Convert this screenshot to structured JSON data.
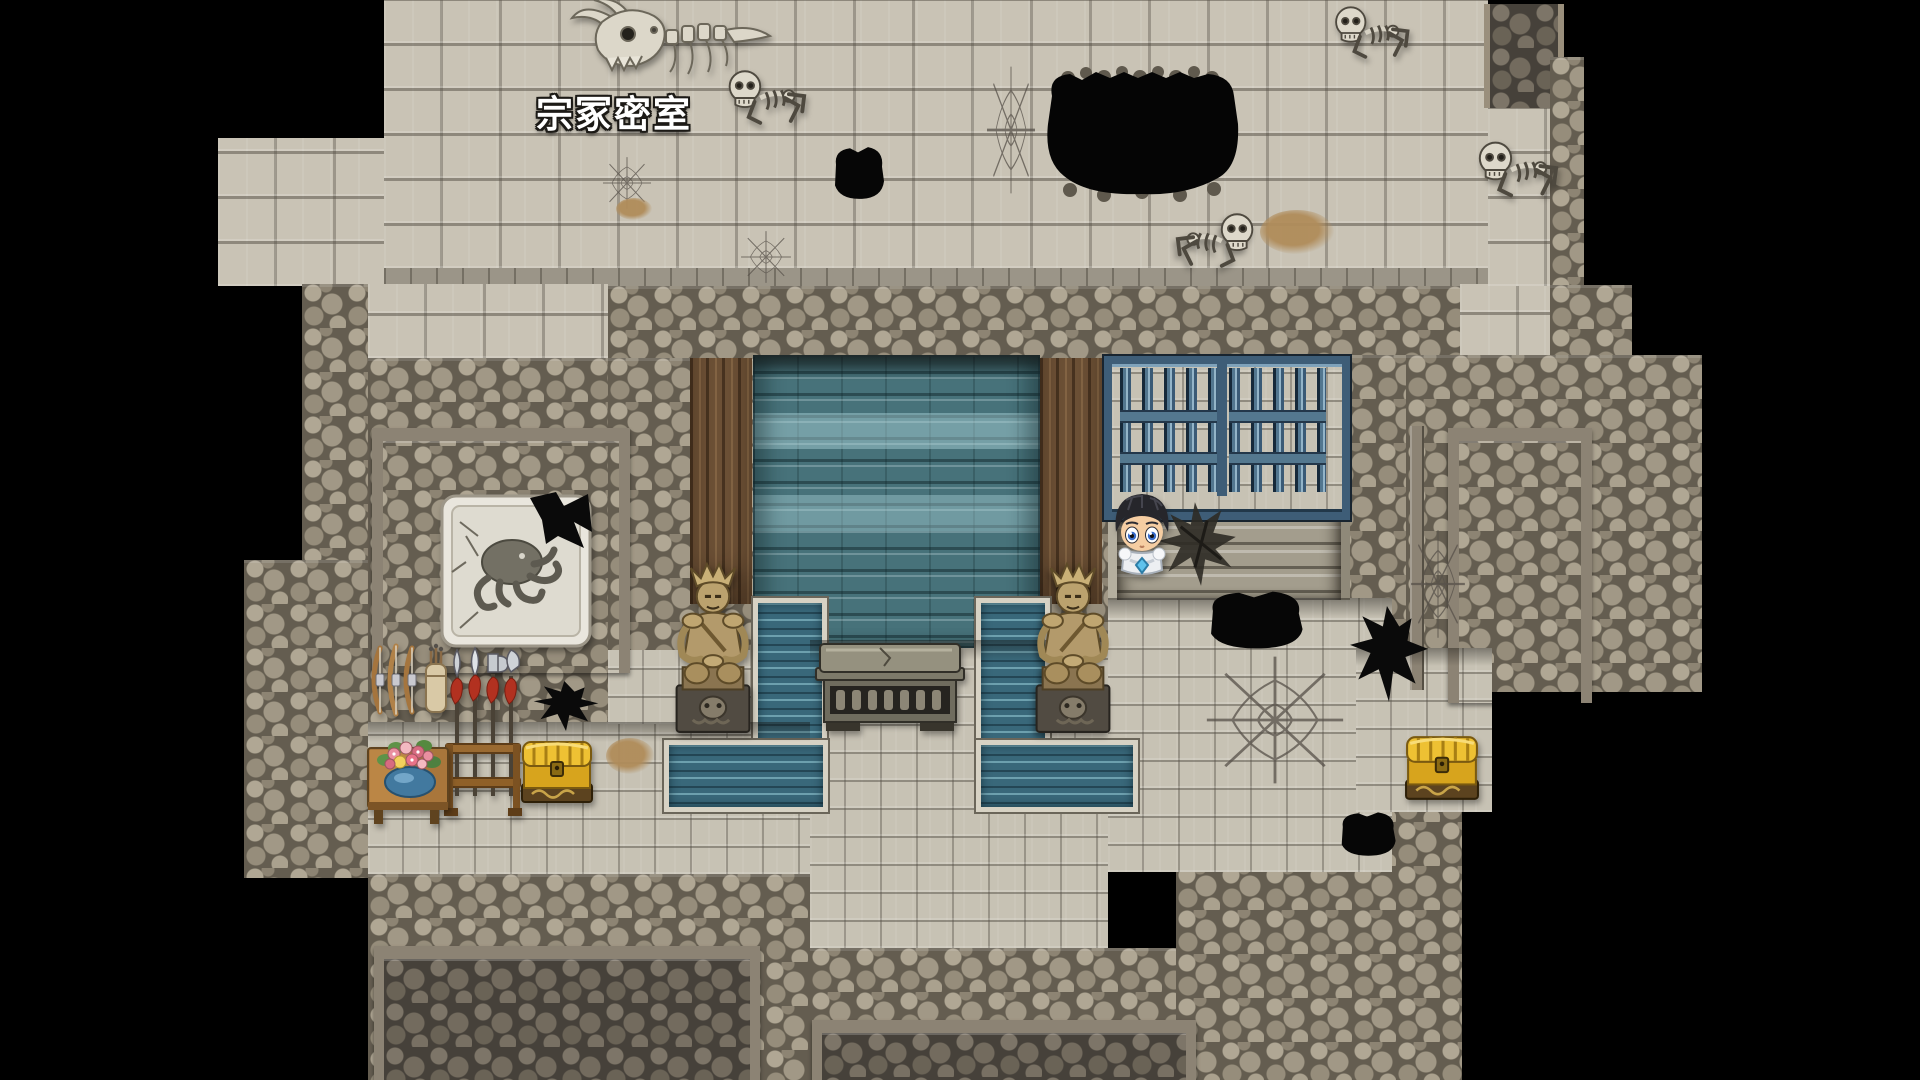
{
  "scene": {
    "map_label": "宗冢密室",
    "palette": {
      "background": "#000000",
      "floor_light": "#c9c3b5",
      "floor_small": "#c7c2b4",
      "cobble": "#9a9183",
      "cobble_dark": "#46413a",
      "beam": "#8c8374",
      "wood": "#6d5136",
      "carpet_teal": "#47727a",
      "water": "#39687a",
      "gate_blue": "#52768f",
      "statue_bronze": "#b39a6b",
      "chest_gold": "#eec133",
      "bone": "#ddd8ca",
      "label_text": "#ffffff"
    }
  },
  "sprites": [
    {
      "type": "dragonskull",
      "name": "dragon-skull-remains",
      "x": 566,
      "y": 0,
      "w": 210,
      "h": 80,
      "interactable": false
    },
    {
      "type": "skeleton",
      "name": "skeleton-crawler-1",
      "x": 722,
      "y": 58,
      "w": 86,
      "h": 80,
      "interactable": false
    },
    {
      "type": "skeleton",
      "name": "skeleton-crawler-2",
      "x": 1326,
      "y": 0,
      "w": 88,
      "h": 66,
      "interactable": false
    },
    {
      "type": "skeleton",
      "name": "skeleton-crawler-3",
      "x": 1472,
      "y": 128,
      "w": 88,
      "h": 84,
      "interactable": false
    },
    {
      "type": "skeleton",
      "name": "skeleton-crawler-4",
      "x": 1174,
      "y": 202,
      "w": 86,
      "h": 78,
      "flip": true,
      "interactable": false
    },
    {
      "type": "bigpit",
      "name": "floor-chasm-large",
      "x": 1034,
      "y": 62,
      "w": 218,
      "h": 144,
      "interactable": false
    },
    {
      "type": "pit",
      "name": "floor-hole-top",
      "x": 828,
      "y": 142,
      "w": 60,
      "h": 62,
      "interactable": false
    },
    {
      "type": "pit",
      "name": "floor-hole-oval",
      "x": 1198,
      "y": 586,
      "w": 112,
      "h": 68,
      "interactable": false
    },
    {
      "type": "pit",
      "name": "floor-hole-bottom",
      "x": 1334,
      "y": 808,
      "w": 66,
      "h": 52,
      "interactable": false
    },
    {
      "type": "jag",
      "name": "floor-hole-jagged-right",
      "x": 1348,
      "y": 604,
      "w": 82,
      "h": 100,
      "interactable": false
    },
    {
      "type": "jag",
      "name": "wall-hole-jagged-left",
      "x": 532,
      "y": 680,
      "w": 68,
      "h": 52,
      "interactable": false
    },
    {
      "type": "web",
      "name": "crack-web-1",
      "x": 986,
      "y": 64,
      "w": 50,
      "h": 132,
      "interactable": false
    },
    {
      "type": "web",
      "name": "crack-web-2",
      "x": 1204,
      "y": 654,
      "w": 142,
      "h": 132,
      "interactable": false
    },
    {
      "type": "web",
      "name": "crack-web-3",
      "x": 740,
      "y": 230,
      "w": 52,
      "h": 54,
      "interactable": false
    },
    {
      "type": "web",
      "name": "crack-web-4",
      "x": 602,
      "y": 156,
      "w": 50,
      "h": 54,
      "interactable": false
    },
    {
      "type": "web",
      "name": "wall-crack",
      "x": 1410,
      "y": 528,
      "w": 56,
      "h": 112,
      "interactable": false
    },
    {
      "type": "patch",
      "name": "dirt-patch-1",
      "x": 1260,
      "y": 210,
      "w": 74,
      "h": 44,
      "interactable": false
    },
    {
      "type": "patch",
      "name": "dirt-patch-2",
      "x": 606,
      "y": 738,
      "w": 48,
      "h": 36,
      "interactable": false
    },
    {
      "type": "patch",
      "name": "dirt-patch-3",
      "x": 616,
      "y": 198,
      "w": 36,
      "h": 22,
      "interactable": false
    },
    {
      "type": "rubble",
      "name": "stair-rubble",
      "x": 1150,
      "y": 496,
      "w": 98,
      "h": 94,
      "interactable": false
    },
    {
      "type": "statue",
      "name": "guardian-statue-left",
      "x": 660,
      "y": 558,
      "w": 106,
      "h": 180,
      "interactable": false
    },
    {
      "type": "statue",
      "name": "guardian-statue-right",
      "x": 1020,
      "y": 558,
      "w": 106,
      "h": 180,
      "flip": true,
      "interactable": false
    },
    {
      "type": "chest",
      "name": "treasure-chest-left",
      "x": 520,
      "y": 738,
      "w": 74,
      "h": 68,
      "interactable": true
    },
    {
      "type": "chest",
      "name": "treasure-chest-right",
      "x": 1404,
      "y": 732,
      "w": 76,
      "h": 72,
      "interactable": true
    }
  ]
}
